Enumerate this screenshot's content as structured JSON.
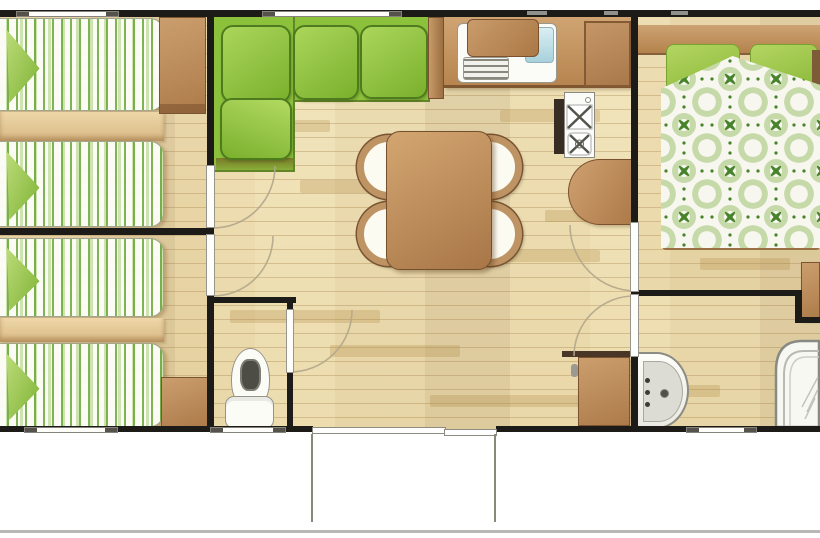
{
  "plan": {
    "type": "floorplan",
    "title": "Mobile-home floor plan (top view)",
    "rooms": [
      {
        "id": "bedroom-1",
        "name": "Twin bedroom 1 (two single beds)"
      },
      {
        "id": "bedroom-2",
        "name": "Twin bedroom 2 (two single beds)"
      },
      {
        "id": "living-dining",
        "name": "Living / dining area"
      },
      {
        "id": "kitchen",
        "name": "Kitchenette"
      },
      {
        "id": "master-bedroom",
        "name": "Master bedroom (double bed)"
      },
      {
        "id": "wc",
        "name": "Separate WC"
      },
      {
        "id": "shower-room",
        "name": "Shower room with washbasin"
      },
      {
        "id": "terrace",
        "name": "Entrance / terrace steps"
      }
    ],
    "furniture": [
      "single-bed",
      "single-bed",
      "single-bed",
      "single-bed",
      "corner-sofa",
      "side-table",
      "dining-table",
      "dining-chair",
      "dining-chair",
      "dining-chair",
      "dining-chair",
      "kitchen-sink-with-drainer",
      "cutting-board",
      "gas-hob-2-burners",
      "fridge-cabinet",
      "half-round-worktop",
      "double-bed",
      "wardrobe",
      "wardrobe",
      "storage-cabinet",
      "storage-cabinet",
      "toilet",
      "washbasin",
      "corner-shower"
    ],
    "colors": {
      "wall": "#1c1b18",
      "floor_light": "#f1e3bb",
      "floor_line": "#d5bf93",
      "sofa_green": "#8cc13c",
      "cushion_green": "#9ccf4a",
      "bedding_stripe_green": "#6fae3c",
      "duvet_pattern_green": "#47832a",
      "furniture_brown": "#bf9264",
      "fixture_white": "#fbfbf6",
      "water_blue": "#bcdde6"
    }
  }
}
